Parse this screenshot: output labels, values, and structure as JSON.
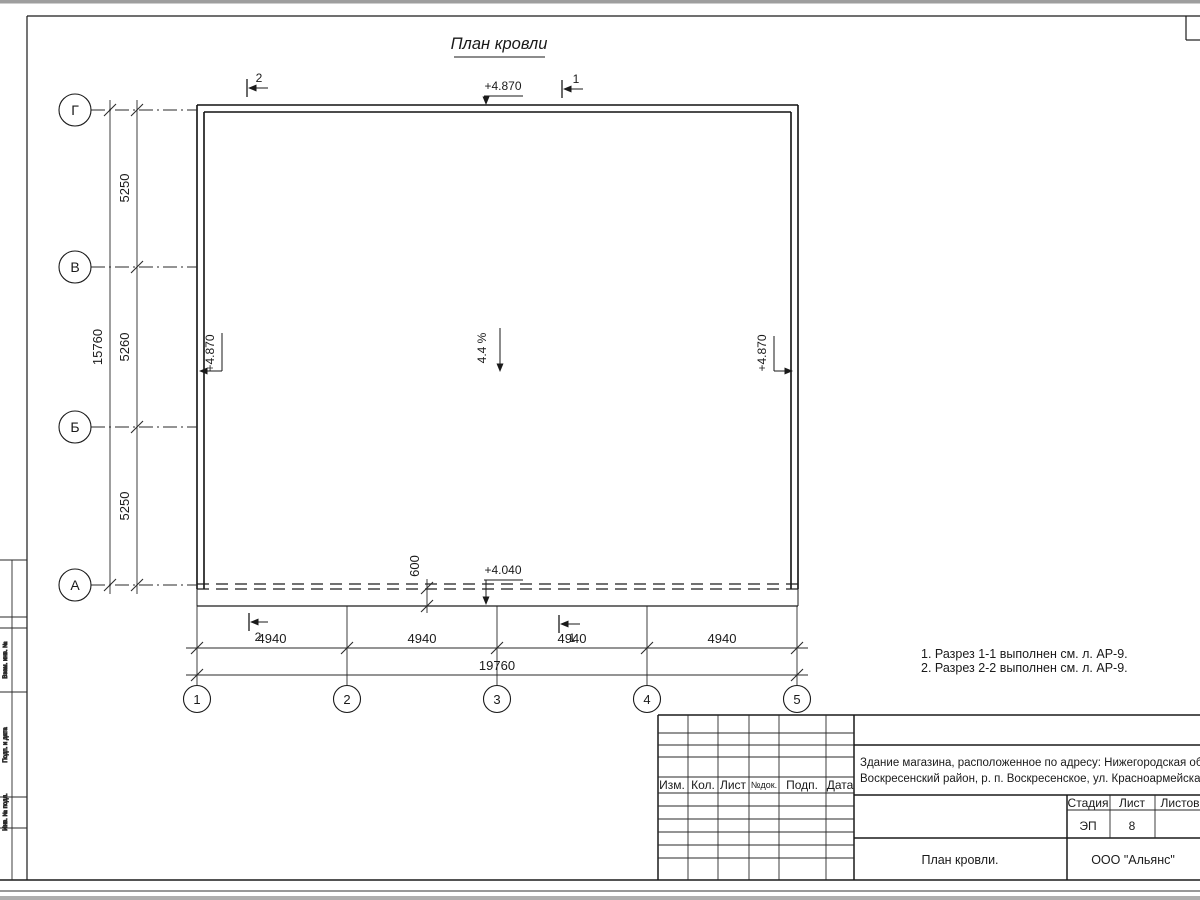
{
  "drawing": {
    "title": "План кровли",
    "slope": "4.4 %",
    "notes": [
      "1. Разрез 1-1 выполнен см. л. АР-9.",
      "2. Разрез 2-2 выполнен см. л. АР-9."
    ],
    "axes": {
      "vertical": [
        "Г",
        "В",
        "Б",
        "А"
      ],
      "horizontal": [
        "1",
        "2",
        "3",
        "4",
        "5"
      ]
    },
    "dims": {
      "left_total": "15760",
      "left_segments": [
        "5250",
        "5260",
        "5250"
      ],
      "bottom_segments": [
        "4940",
        "4940",
        "4940",
        "4940"
      ],
      "bottom_total": "19760",
      "eave_offset": "600"
    },
    "elevations": {
      "roof_top": "+4.870",
      "roof_left": "+4.870",
      "roof_right": "+4.870",
      "canopy": "+4.040"
    },
    "sections": {
      "one": "1",
      "two": "2"
    }
  },
  "title_block": {
    "columns": [
      "Изм.",
      "Кол.",
      "Лист",
      "№док.",
      "Подп.",
      "Дата"
    ],
    "project_line1": "Здание магазина, расположенное по адресу: Нижегородская область,",
    "project_line2": "Воскресенский район, р. п. Воскресенское, ул. Красноармейская, д. 1",
    "stage_label": "Стадия",
    "sheet_label": "Лист",
    "sheets_label": "Листов",
    "stage_value": "ЭП",
    "sheet_value": "8",
    "drawing_name": "План кровли.",
    "company": "ООО \"Альянс\""
  },
  "side_stamp": {
    "labels": [
      "Взам. инв. №",
      "Подп. и дата",
      "Инв. № подл."
    ]
  }
}
